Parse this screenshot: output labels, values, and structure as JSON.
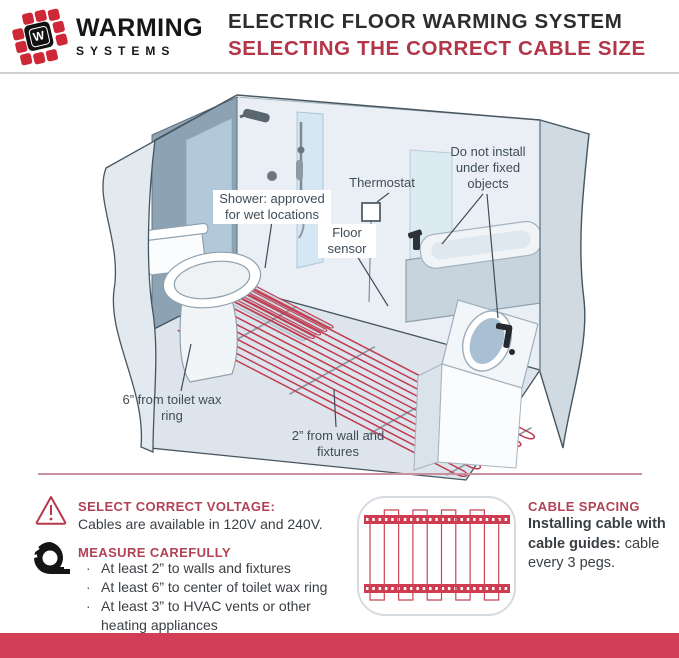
{
  "header": {
    "logo_monogram": "W",
    "brand_line1": "WARMING",
    "brand_line2": "SYSTEMS",
    "title_line1": "ELECTRIC FLOOR WARMING SYSTEM",
    "title_line2": "SELECTING THE CORRECT CABLE SIZE"
  },
  "diagram": {
    "labels": {
      "shower": "Shower: approved for wet locations",
      "thermostat": "Thermostat",
      "floor_sensor": "Floor sensor",
      "fixed_objects": "Do not install under fixed objects",
      "toilet": "6” from toilet wax ring",
      "wall": "2” from wall and fixtures"
    }
  },
  "info": {
    "voltage": {
      "title": "SELECT CORRECT VOLTAGE:",
      "body": "Cables are available in 120V and 240V."
    },
    "measure": {
      "title": "MEASURE CAREFULLY",
      "bullets": [
        "At least 2” to walls and fixtures",
        "At least 6” to center of toilet wax ring",
        "At least 3” to HVAC vents or other heating appliances"
      ]
    },
    "spacing": {
      "title": "CABLE SPACING",
      "bold": "Installing cable with cable guides:",
      "rest": " cable every 3 pegs."
    }
  },
  "colors": {
    "accent_red_title": "#b23548",
    "accent_red_heading": "#b04355",
    "cable_red": "#c03c50",
    "logo_red": "#ce2838",
    "bottom_bar_red": "#d23e55",
    "divider_pink": "#c9919e",
    "label_text": "#3f4d59"
  }
}
